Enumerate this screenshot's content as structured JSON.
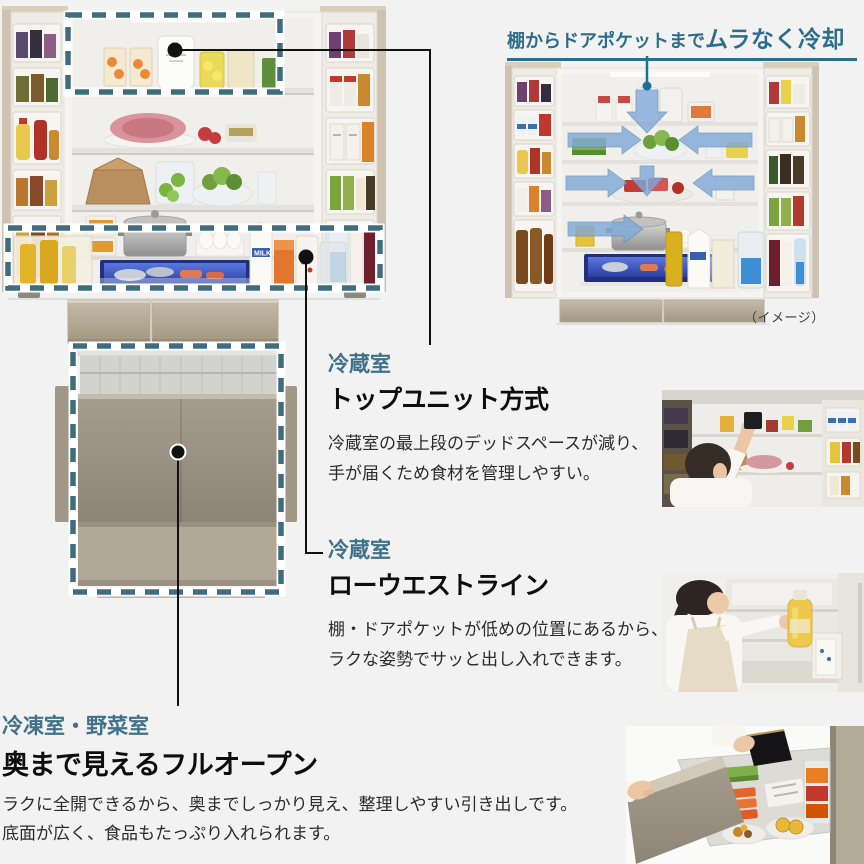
{
  "page": {
    "background": "#f2f2f2"
  },
  "colors": {
    "accent_teal_label": "#40718a",
    "accent_teal_title": "#2d6d8c",
    "highlight_dash_teal": "#3e6d7e",
    "heading_black": "#0d0d0d",
    "body_text": "#2b2b2b",
    "callout_line": "#111111",
    "airflow_blue": "#7fa9d8",
    "fridge_champagne": "#cdc3b0"
  },
  "cooling_feature": {
    "title_regular": "棚からドアポケットまで",
    "title_bold": "ムラなく冷却",
    "image_caption": "（イメージ）"
  },
  "features": {
    "top_unit": {
      "category": "冷蔵室",
      "title": "トップユニット方式",
      "body_line1": "冷蔵室の最上段のデッドスペースが減り、",
      "body_line2": "手が届くため食材を管理しやすい。"
    },
    "low_waist": {
      "category": "冷蔵室",
      "title": "ローウエストライン",
      "body_line1": "棚・ドアポケットが低めの位置にあるから、",
      "body_line2": "ラクな姿勢でサッと出し入れできます。"
    },
    "full_open": {
      "category": "冷凍室・野菜室",
      "title": "奥まで見えるフルオープン",
      "body_line1": "ラクに全開できるから、奥までしっかり見え、整理しやすい引き出しです。",
      "body_line2": "底面が広く、食品もたっぷり入れられます。"
    }
  },
  "illustration_labels": {
    "milk_carton": "MILK"
  },
  "icons": {
    "callout-dot-icon": "●",
    "airflow-down-arrow-icon": "⬇",
    "airflow-sweep-arrow-icon": "➡",
    "highlight-dashed-box": "▭"
  }
}
